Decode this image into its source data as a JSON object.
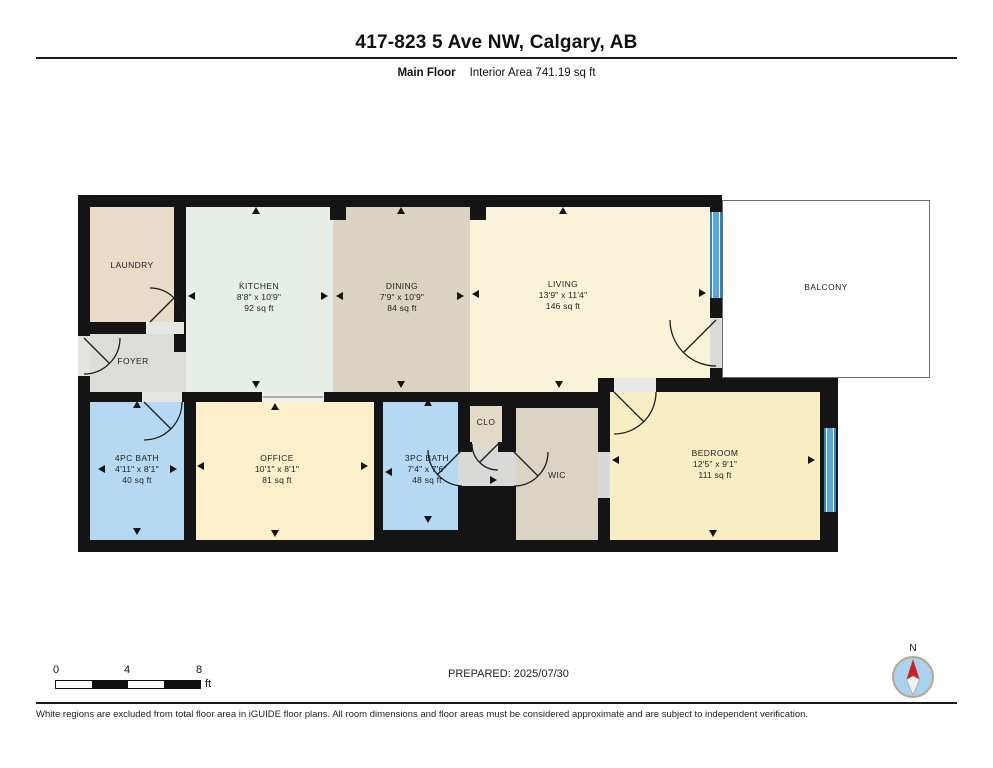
{
  "header": {
    "title": "417-823 5 Ave NW, Calgary, AB",
    "floor_label": "Main Floor",
    "area_label": "Interior Area 741.19 sq ft"
  },
  "floor_plan": {
    "rooms": [
      {
        "id": "laundry",
        "rect": [
          90,
          207,
          84,
          115
        ],
        "color": "#e8dcc8",
        "label_pos": [
          132,
          260
        ],
        "lines": [
          "LAUNDRY"
        ]
      },
      {
        "id": "foyer",
        "rect": [
          90,
          334,
          84,
          58
        ],
        "color": "#dcdcd9",
        "label_pos": [
          133,
          356
        ],
        "lines": [
          "FOYER"
        ]
      },
      {
        "id": "foyer-ext",
        "rect": [
          174,
          352,
          12,
          40
        ],
        "color": "#dcdcd9",
        "label_pos": null,
        "lines": []
      },
      {
        "id": "kitchen",
        "rect": [
          186,
          207,
          147,
          185
        ],
        "color": "#e6efe7",
        "label_pos": [
          259,
          281
        ],
        "lines": [
          "KITCHEN",
          "8'8\" x 10'9\"",
          "92 sq ft"
        ]
      },
      {
        "id": "dining",
        "rect": [
          333,
          207,
          137,
          185
        ],
        "color": "#dbd3c2",
        "label_pos": [
          402,
          281
        ],
        "lines": [
          "DINING",
          "7'9\" x 10'9\"",
          "84 sq ft"
        ]
      },
      {
        "id": "living",
        "rect": [
          470,
          207,
          240,
          171
        ],
        "color": "#faf3d9",
        "label_pos": [
          563,
          279
        ],
        "lines": [
          "LIVING",
          "13'9\" x 11'4\"",
          "146 sq ft"
        ]
      },
      {
        "id": "living-ext",
        "rect": [
          470,
          378,
          128,
          14
        ],
        "color": "#faf3d9",
        "label_pos": null,
        "lines": []
      },
      {
        "id": "balcony",
        "rect": [
          722,
          200,
          208,
          178
        ],
        "color": "#ffffff",
        "outlined": true,
        "label_pos": [
          826,
          282
        ],
        "lines": [
          "BALCONY"
        ]
      },
      {
        "id": "bath4",
        "rect": [
          90,
          402,
          94,
          138
        ],
        "color": "#b5d8f3",
        "label_pos": [
          137,
          453
        ],
        "lines": [
          "4PC BATH",
          "4'11\" x 8'1\"",
          "40 sq ft"
        ]
      },
      {
        "id": "office",
        "rect": [
          196,
          402,
          178,
          138
        ],
        "color": "#fcefca",
        "label_pos": [
          277,
          453
        ],
        "lines": [
          "OFFICE",
          "10'1\" x 8'1\"",
          "81 sq ft"
        ]
      },
      {
        "id": "bath3",
        "rect": [
          383,
          402,
          75,
          128
        ],
        "color": "#b5d8f3",
        "label_pos": [
          427,
          453
        ],
        "lines": [
          "3PC BATH",
          "7'4\" x 7'6\"",
          "48 sq ft"
        ]
      },
      {
        "id": "clo",
        "rect": [
          470,
          406,
          32,
          36
        ],
        "color": "#e3d9c6",
        "label_pos": [
          486,
          417
        ],
        "lines": [
          "CLO"
        ]
      },
      {
        "id": "wic",
        "rect": [
          516,
          408,
          82,
          132
        ],
        "color": "#dbd3c3",
        "label_pos": [
          557,
          470
        ],
        "lines": [
          "WIC"
        ]
      },
      {
        "id": "bedroom",
        "rect": [
          610,
          392,
          210,
          148
        ],
        "color": "#f9edc4",
        "label_pos": [
          715,
          448
        ],
        "lines": [
          "BEDROOM",
          "12'5\" x 9'1\"",
          "111 sq ft"
        ]
      }
    ],
    "arrows": [
      {
        "x": 256,
        "y": 211,
        "dir": "up"
      },
      {
        "x": 256,
        "y": 385,
        "dir": "down"
      },
      {
        "x": 192,
        "y": 296,
        "dir": "left"
      },
      {
        "x": 325,
        "y": 296,
        "dir": "right"
      },
      {
        "x": 401,
        "y": 211,
        "dir": "up"
      },
      {
        "x": 401,
        "y": 385,
        "dir": "down"
      },
      {
        "x": 340,
        "y": 296,
        "dir": "left"
      },
      {
        "x": 461,
        "y": 296,
        "dir": "right"
      },
      {
        "x": 563,
        "y": 211,
        "dir": "up"
      },
      {
        "x": 559,
        "y": 385,
        "dir": "down"
      },
      {
        "x": 476,
        "y": 294,
        "dir": "left"
      },
      {
        "x": 703,
        "y": 293,
        "dir": "right"
      },
      {
        "x": 137,
        "y": 405,
        "dir": "up"
      },
      {
        "x": 137,
        "y": 532,
        "dir": "down"
      },
      {
        "x": 102,
        "y": 469,
        "dir": "left"
      },
      {
        "x": 174,
        "y": 469,
        "dir": "right"
      },
      {
        "x": 275,
        "y": 407,
        "dir": "up"
      },
      {
        "x": 275,
        "y": 534,
        "dir": "down"
      },
      {
        "x": 201,
        "y": 466,
        "dir": "left"
      },
      {
        "x": 365,
        "y": 466,
        "dir": "right"
      },
      {
        "x": 428,
        "y": 403,
        "dir": "up"
      },
      {
        "x": 428,
        "y": 520,
        "dir": "down"
      },
      {
        "x": 389,
        "y": 472,
        "dir": "left"
      },
      {
        "x": 494,
        "y": 480,
        "dir": "right"
      },
      {
        "x": 713,
        "y": 388,
        "dir": "up"
      },
      {
        "x": 713,
        "y": 534,
        "dir": "down"
      },
      {
        "x": 616,
        "y": 460,
        "dir": "left"
      },
      {
        "x": 812,
        "y": 460,
        "dir": "right"
      }
    ]
  },
  "scale_bar": {
    "tick_labels": [
      "0",
      "4",
      "8"
    ],
    "unit": "ft"
  },
  "prepared_label": "PREPARED: 2025/07/30",
  "compass": {
    "label": "N"
  },
  "footer": {
    "disclaimer": "White regions are excluded from total floor area in iGUIDE floor plans. All room dimensions and floor areas must be considered approximate and are subject to independent verification."
  },
  "colors": {
    "wall": "#141414",
    "window_blue": "#5aa7dc",
    "bath_blue": "#b5d8f3",
    "cream": "#faf3d9",
    "tan": "#dbd3c2",
    "mint": "#e6efe7",
    "compass_red": "#cf1f1f"
  }
}
